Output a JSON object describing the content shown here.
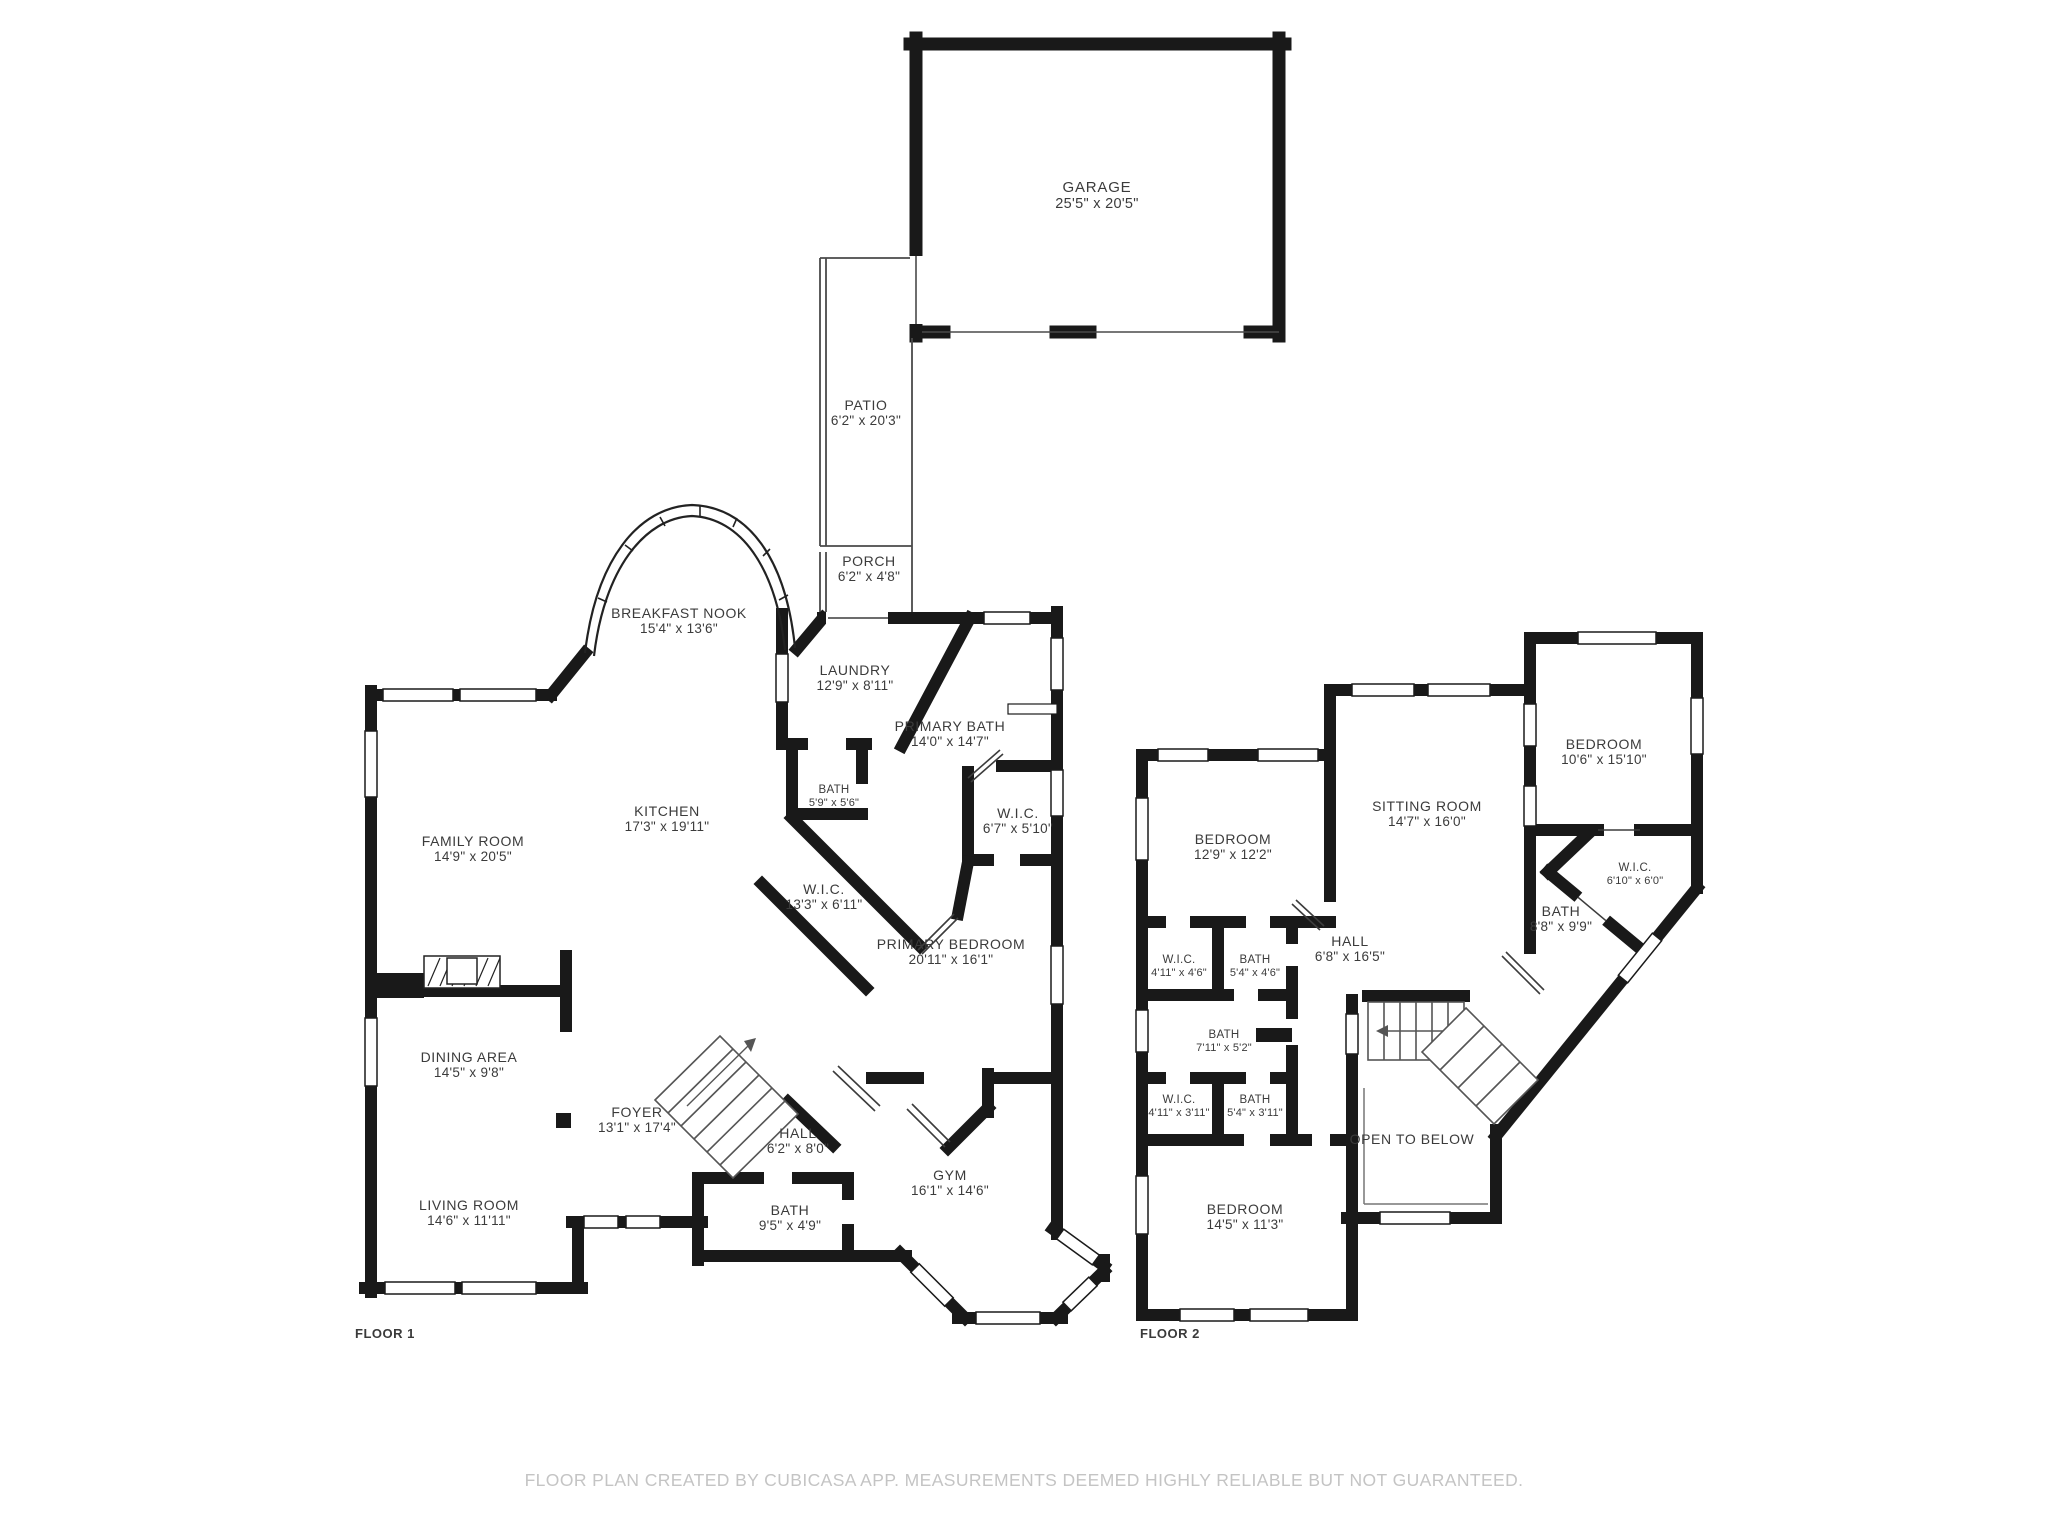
{
  "colors": {
    "wall": "#191919",
    "text": "#3b3b3b",
    "footer_text": "#c4c4c4",
    "background": "#ffffff"
  },
  "footer": {
    "text": "FLOOR PLAN CREATED BY CUBICASA APP. MEASUREMENTS DEEMED HIGHLY RELIABLE BUT NOT GUARANTEED."
  },
  "floor1": {
    "label": "FLOOR 1",
    "rooms": [
      {
        "name": "GARAGE",
        "dims": "25'5\" x 20'5\""
      },
      {
        "name": "PATIO",
        "dims": "6'2\" x 20'3\""
      },
      {
        "name": "PORCH",
        "dims": "6'2\" x 4'8\""
      },
      {
        "name": "BREAKFAST NOOK",
        "dims": "15'4\" x 13'6\""
      },
      {
        "name": "LAUNDRY",
        "dims": "12'9\" x 8'11\""
      },
      {
        "name": "PRIMARY BATH",
        "dims": "14'0\" x 14'7\""
      },
      {
        "name": "BATH",
        "dims": "5'9\" x 5'6\""
      },
      {
        "name": "W.I.C.",
        "dims": "6'7\" x 5'10\""
      },
      {
        "name": "KITCHEN",
        "dims": "17'3\" x 19'11\""
      },
      {
        "name": "FAMILY ROOM",
        "dims": "14'9\" x 20'5\""
      },
      {
        "name": "W.I.C.",
        "dims": "13'3\" x 6'11\""
      },
      {
        "name": "PRIMARY BEDROOM",
        "dims": "20'11\" x 16'1\""
      },
      {
        "name": "DINING AREA",
        "dims": "14'5\" x 9'8\""
      },
      {
        "name": "FOYER",
        "dims": "13'1\" x 17'4\""
      },
      {
        "name": "HALL",
        "dims": "6'2\" x 8'0\""
      },
      {
        "name": "LIVING ROOM",
        "dims": "14'6\" x 11'11\""
      },
      {
        "name": "BATH",
        "dims": "9'5\" x 4'9\""
      },
      {
        "name": "GYM",
        "dims": "16'1\" x 14'6\""
      }
    ]
  },
  "floor2": {
    "label": "FLOOR 2",
    "rooms": [
      {
        "name": "BEDROOM",
        "dims": "12'9\" x 12'2\""
      },
      {
        "name": "SITTING ROOM",
        "dims": "14'7\" x 16'0\""
      },
      {
        "name": "BEDROOM",
        "dims": "10'6\" x 15'10\""
      },
      {
        "name": "W.I.C.",
        "dims": "6'10\" x 6'0\""
      },
      {
        "name": "BATH",
        "dims": "8'8\" x 9'9\""
      },
      {
        "name": "HALL",
        "dims": "6'8\" x 16'5\""
      },
      {
        "name": "W.I.C.",
        "dims": "4'11\" x 4'6\""
      },
      {
        "name": "BATH",
        "dims": "5'4\" x 4'6\""
      },
      {
        "name": "BATH",
        "dims": "7'11\" x 5'2\""
      },
      {
        "name": "W.I.C.",
        "dims": "4'11\" x 3'11\""
      },
      {
        "name": "BATH",
        "dims": "5'4\" x 3'11\""
      },
      {
        "name": "OPEN TO BELOW",
        "dims": ""
      },
      {
        "name": "BEDROOM",
        "dims": "14'5\" x 11'3\""
      }
    ]
  }
}
